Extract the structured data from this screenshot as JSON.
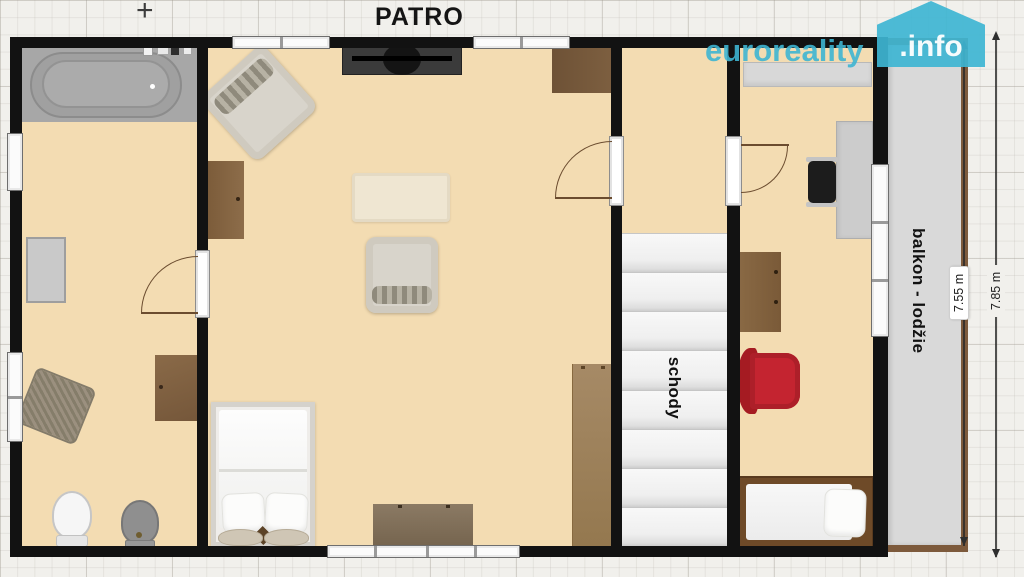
{
  "title": "PATRO",
  "crosshair": "+",
  "watermark": {
    "brand": "euroreality",
    "domain": ".info"
  },
  "labels": {
    "stairs": "schody",
    "balcony": "balkon - lodžie"
  },
  "dimensions": {
    "inner": "7.55 m",
    "outer": "7.85 m"
  },
  "colors": {
    "wall": "#121212",
    "floor": "#f3dcb2",
    "balcony_floor": "#d9d9d9",
    "railing": "#7d5a3c",
    "wood": "#85643f",
    "armchair_red": "#c0242c",
    "watermark": "#3eb5d2"
  }
}
